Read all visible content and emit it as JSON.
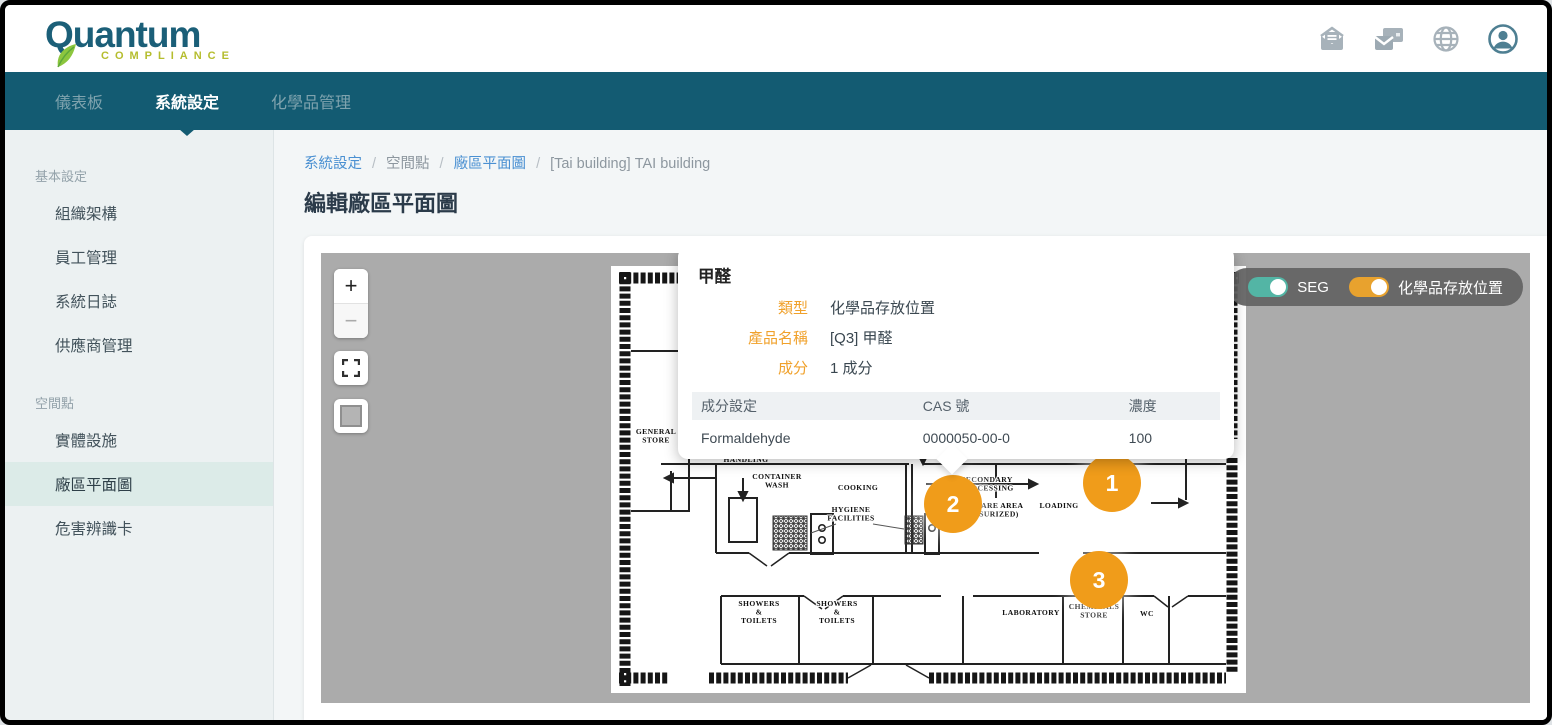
{
  "brand": {
    "name": "Quantum",
    "tagline": "COMPLIANCE"
  },
  "header": {
    "icons": [
      "inbox-mail-icon",
      "mail-card-icon",
      "globe-icon",
      "account-icon"
    ]
  },
  "nav": {
    "items": [
      {
        "label": "儀表板",
        "active": false
      },
      {
        "label": "系統設定",
        "active": true
      },
      {
        "label": "化學品管理",
        "active": false
      }
    ]
  },
  "sidebar": {
    "sections": [
      {
        "label": "基本設定",
        "items": [
          {
            "label": "組織架構",
            "active": false
          },
          {
            "label": "員工管理",
            "active": false
          },
          {
            "label": "系統日誌",
            "active": false
          },
          {
            "label": "供應商管理",
            "active": false
          }
        ]
      },
      {
        "label": "空間點",
        "items": [
          {
            "label": "實體設施",
            "active": false
          },
          {
            "label": "廠區平面圖",
            "active": true
          },
          {
            "label": "危害辨識卡",
            "active": false
          }
        ]
      }
    ]
  },
  "breadcrumb": {
    "separator": "/",
    "items": [
      {
        "label": "系統設定",
        "link": true
      },
      {
        "label": "空間點",
        "link": false
      },
      {
        "label": "廠區平面圖",
        "link": true
      },
      {
        "label": "[Tai building] TAI building",
        "link": false
      }
    ]
  },
  "page": {
    "title": "編輯廠區平面圖"
  },
  "map": {
    "controls": {
      "zoom_in": "+",
      "zoom_out": "−"
    },
    "toggles": [
      {
        "label": "SEG",
        "on": true,
        "color": "#53b5a5"
      },
      {
        "label": "化學品存放位置",
        "on": true,
        "color": "#e8a22e"
      }
    ],
    "markers": [
      {
        "label": "1",
        "x": 791,
        "y": 230
      },
      {
        "label": "2",
        "x": 632,
        "y": 251
      },
      {
        "label": "3",
        "x": 778,
        "y": 327
      }
    ],
    "popup": {
      "title": "甲醛",
      "fields": [
        {
          "label": "類型",
          "value": "化學品存放位置"
        },
        {
          "label": "產品名稱",
          "value": "[Q3] 甲醛"
        },
        {
          "label": "成分",
          "value": "1 成分"
        }
      ],
      "table": {
        "headers": [
          "成分設定",
          "CAS 號",
          "濃度"
        ],
        "rows": [
          [
            "Formaldehyde",
            "0000050-00-0",
            "100"
          ]
        ]
      }
    },
    "floorplan_labels": [
      {
        "lines": [
          "GENERAL",
          "STORE"
        ],
        "x": 45,
        "y": 168
      },
      {
        "lines": [
          "HANDLING"
        ],
        "x": 135,
        "y": 196
      },
      {
        "lines": [
          "CONTAINER",
          "WASH"
        ],
        "x": 166,
        "y": 213
      },
      {
        "lines": [
          "COOKING"
        ],
        "x": 247,
        "y": 224
      },
      {
        "lines": [
          "HYGIENE",
          "FACILITIES"
        ],
        "x": 240,
        "y": 246
      },
      {
        "lines": [
          "SECONDARY",
          "PROCESSING"
        ],
        "x": 376,
        "y": 216
      },
      {
        "lines": [
          "HIGH CARE AREA",
          "(PRESSURIZED)"
        ],
        "x": 376,
        "y": 242
      },
      {
        "lines": [
          "LOADING"
        ],
        "x": 448,
        "y": 242
      },
      {
        "lines": [
          "SHOWERS",
          "&",
          "TOILETS"
        ],
        "x": 148,
        "y": 340
      },
      {
        "lines": [
          "SHOWERS",
          "&",
          "TOILETS"
        ],
        "x": 226,
        "y": 340
      },
      {
        "lines": [
          "LABORATORY"
        ],
        "x": 420,
        "y": 349
      },
      {
        "lines": [
          "CHEMICALS",
          "STORE"
        ],
        "x": 483,
        "y": 343
      },
      {
        "lines": [
          "WC"
        ],
        "x": 536,
        "y": 350
      }
    ]
  },
  "colors": {
    "navbar": "#135b72",
    "logo_text": "#1b5f78",
    "logo_tagline": "#b5bd2e",
    "accent_orange": "#f09c1a",
    "link_blue": "#4a90d2",
    "sidebar_bg": "#ecf1f2",
    "sidebar_active_bg": "#dcebe8",
    "map_bg": "#ababab"
  }
}
